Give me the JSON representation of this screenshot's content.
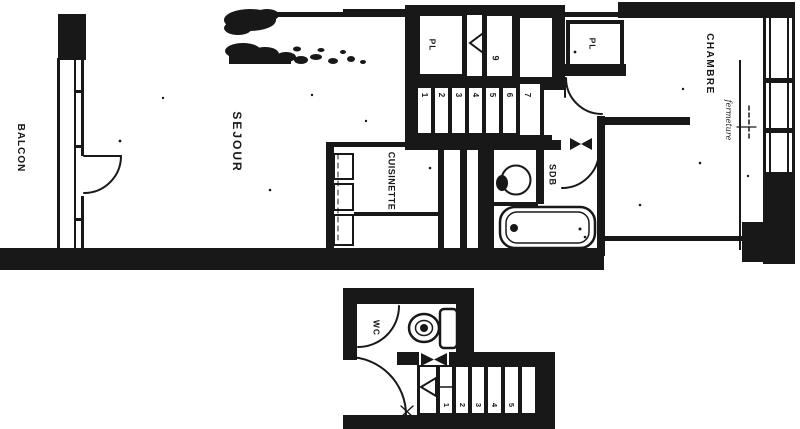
{
  "rooms": {
    "balcon": {
      "label": "BALCON"
    },
    "sejour": {
      "label": "SEJOUR"
    },
    "cuisinette": {
      "label": "CUISINETTE"
    },
    "sdb": {
      "label": "SDB"
    },
    "chambre": {
      "label": "CHAMBRE"
    },
    "wc": {
      "label": "WC"
    },
    "closet_stair": {
      "label": "PL"
    },
    "closet_chambre": {
      "label": "PL"
    }
  },
  "annotations": {
    "fermeture": "fermeture"
  },
  "stairs_upper": {
    "numbers": [
      "1",
      "2",
      "3",
      "4",
      "5",
      "6"
    ],
    "corner_step": "7",
    "upper_step": "9"
  },
  "stairs_lower": {
    "numbers": [
      "1",
      "2",
      "3",
      "4",
      "5"
    ]
  },
  "colors": {
    "ink": "#181818",
    "paper": "#ffffff"
  }
}
